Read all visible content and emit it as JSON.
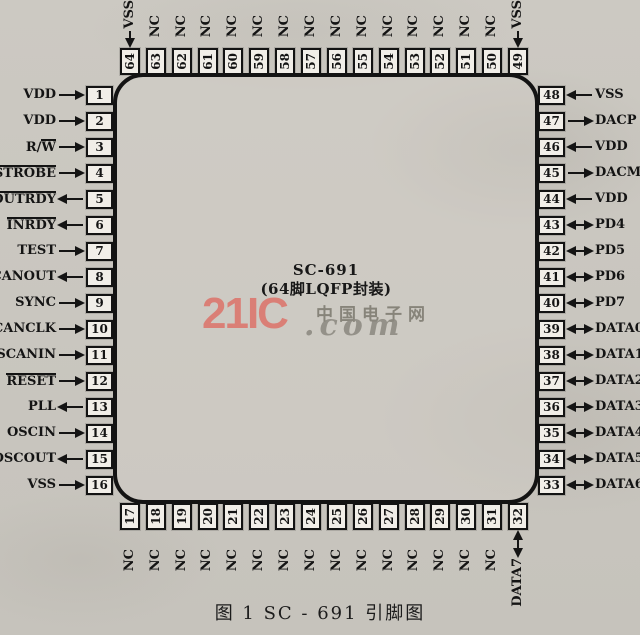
{
  "chip": {
    "name": "SC-691",
    "package": "(64脚LQFP封装)"
  },
  "watermark": {
    "brand": "21IC",
    "cn": "中国电子网",
    "suffix": ".com",
    "brand_color": "#dd6f66"
  },
  "caption": "图 1   SC - 691 引脚图",
  "pins": {
    "left": [
      {
        "num": "1",
        "label": "VDD",
        "dir": "in"
      },
      {
        "num": "2",
        "label": "VDD",
        "dir": "in"
      },
      {
        "num": "3",
        "label": "R/W",
        "overline": "W",
        "dir": "in"
      },
      {
        "num": "4",
        "label": "STROBE",
        "overline": "STROBE",
        "dir": "in"
      },
      {
        "num": "5",
        "label": "OUTRDY",
        "overline": "OUTRDY",
        "dir": "out"
      },
      {
        "num": "6",
        "label": "INRDY",
        "overline": "INRDY",
        "dir": "out"
      },
      {
        "num": "7",
        "label": "TEST",
        "dir": "in"
      },
      {
        "num": "8",
        "label": "SCANOUT",
        "dir": "out"
      },
      {
        "num": "9",
        "label": "SYNC",
        "dir": "in"
      },
      {
        "num": "10",
        "label": "SCANCLK",
        "dir": "in"
      },
      {
        "num": "11",
        "label": "SCANIN",
        "dir": "in"
      },
      {
        "num": "12",
        "label": "RESET",
        "overline": "RESET",
        "dir": "in"
      },
      {
        "num": "13",
        "label": "PLL",
        "dir": "out"
      },
      {
        "num": "14",
        "label": "OSCIN",
        "dir": "in"
      },
      {
        "num": "15",
        "label": "OSCOUT",
        "dir": "out"
      },
      {
        "num": "16",
        "label": "VSS",
        "dir": "in"
      }
    ],
    "top": [
      {
        "num": "64",
        "label": "VSS",
        "dir": "in"
      },
      {
        "num": "63",
        "label": "NC",
        "dir": "none"
      },
      {
        "num": "62",
        "label": "NC",
        "dir": "none"
      },
      {
        "num": "61",
        "label": "NC",
        "dir": "none"
      },
      {
        "num": "60",
        "label": "NC",
        "dir": "none"
      },
      {
        "num": "59",
        "label": "NC",
        "dir": "none"
      },
      {
        "num": "58",
        "label": "NC",
        "dir": "none"
      },
      {
        "num": "57",
        "label": "NC",
        "dir": "none"
      },
      {
        "num": "56",
        "label": "NC",
        "dir": "none"
      },
      {
        "num": "55",
        "label": "NC",
        "dir": "none"
      },
      {
        "num": "54",
        "label": "NC",
        "dir": "none"
      },
      {
        "num": "53",
        "label": "NC",
        "dir": "none"
      },
      {
        "num": "52",
        "label": "NC",
        "dir": "none"
      },
      {
        "num": "51",
        "label": "NC",
        "dir": "none"
      },
      {
        "num": "50",
        "label": "NC",
        "dir": "none"
      },
      {
        "num": "49",
        "label": "VSS",
        "dir": "in"
      }
    ],
    "right": [
      {
        "num": "48",
        "label": "VSS",
        "dir": "in"
      },
      {
        "num": "47",
        "label": "DACP",
        "dir": "out"
      },
      {
        "num": "46",
        "label": "VDD",
        "dir": "in"
      },
      {
        "num": "45",
        "label": "DACM",
        "dir": "out"
      },
      {
        "num": "44",
        "label": "VDD",
        "dir": "in"
      },
      {
        "num": "43",
        "label": "PD4",
        "dir": "bi"
      },
      {
        "num": "42",
        "label": "PD5",
        "dir": "bi"
      },
      {
        "num": "41",
        "label": "PD6",
        "dir": "bi"
      },
      {
        "num": "40",
        "label": "PD7",
        "dir": "bi"
      },
      {
        "num": "39",
        "label": "DATA0",
        "dir": "bi"
      },
      {
        "num": "38",
        "label": "DATA1",
        "dir": "bi"
      },
      {
        "num": "37",
        "label": "DATA2",
        "dir": "bi"
      },
      {
        "num": "36",
        "label": "DATA3",
        "dir": "bi"
      },
      {
        "num": "35",
        "label": "DATA4",
        "dir": "bi"
      },
      {
        "num": "34",
        "label": "DATA5",
        "dir": "bi"
      },
      {
        "num": "33",
        "label": "DATA6",
        "dir": "bi"
      }
    ],
    "bottom": [
      {
        "num": "17",
        "label": "NC",
        "dir": "none"
      },
      {
        "num": "18",
        "label": "NC",
        "dir": "none"
      },
      {
        "num": "19",
        "label": "NC",
        "dir": "none"
      },
      {
        "num": "20",
        "label": "NC",
        "dir": "none"
      },
      {
        "num": "21",
        "label": "NC",
        "dir": "none"
      },
      {
        "num": "22",
        "label": "NC",
        "dir": "none"
      },
      {
        "num": "23",
        "label": "NC",
        "dir": "none"
      },
      {
        "num": "24",
        "label": "NC",
        "dir": "none"
      },
      {
        "num": "25",
        "label": "NC",
        "dir": "none"
      },
      {
        "num": "26",
        "label": "NC",
        "dir": "none"
      },
      {
        "num": "27",
        "label": "NC",
        "dir": "none"
      },
      {
        "num": "28",
        "label": "NC",
        "dir": "none"
      },
      {
        "num": "29",
        "label": "NC",
        "dir": "none"
      },
      {
        "num": "30",
        "label": "NC",
        "dir": "none"
      },
      {
        "num": "31",
        "label": "NC",
        "dir": "none"
      },
      {
        "num": "32",
        "label": "DATA7",
        "dir": "bi"
      }
    ]
  }
}
